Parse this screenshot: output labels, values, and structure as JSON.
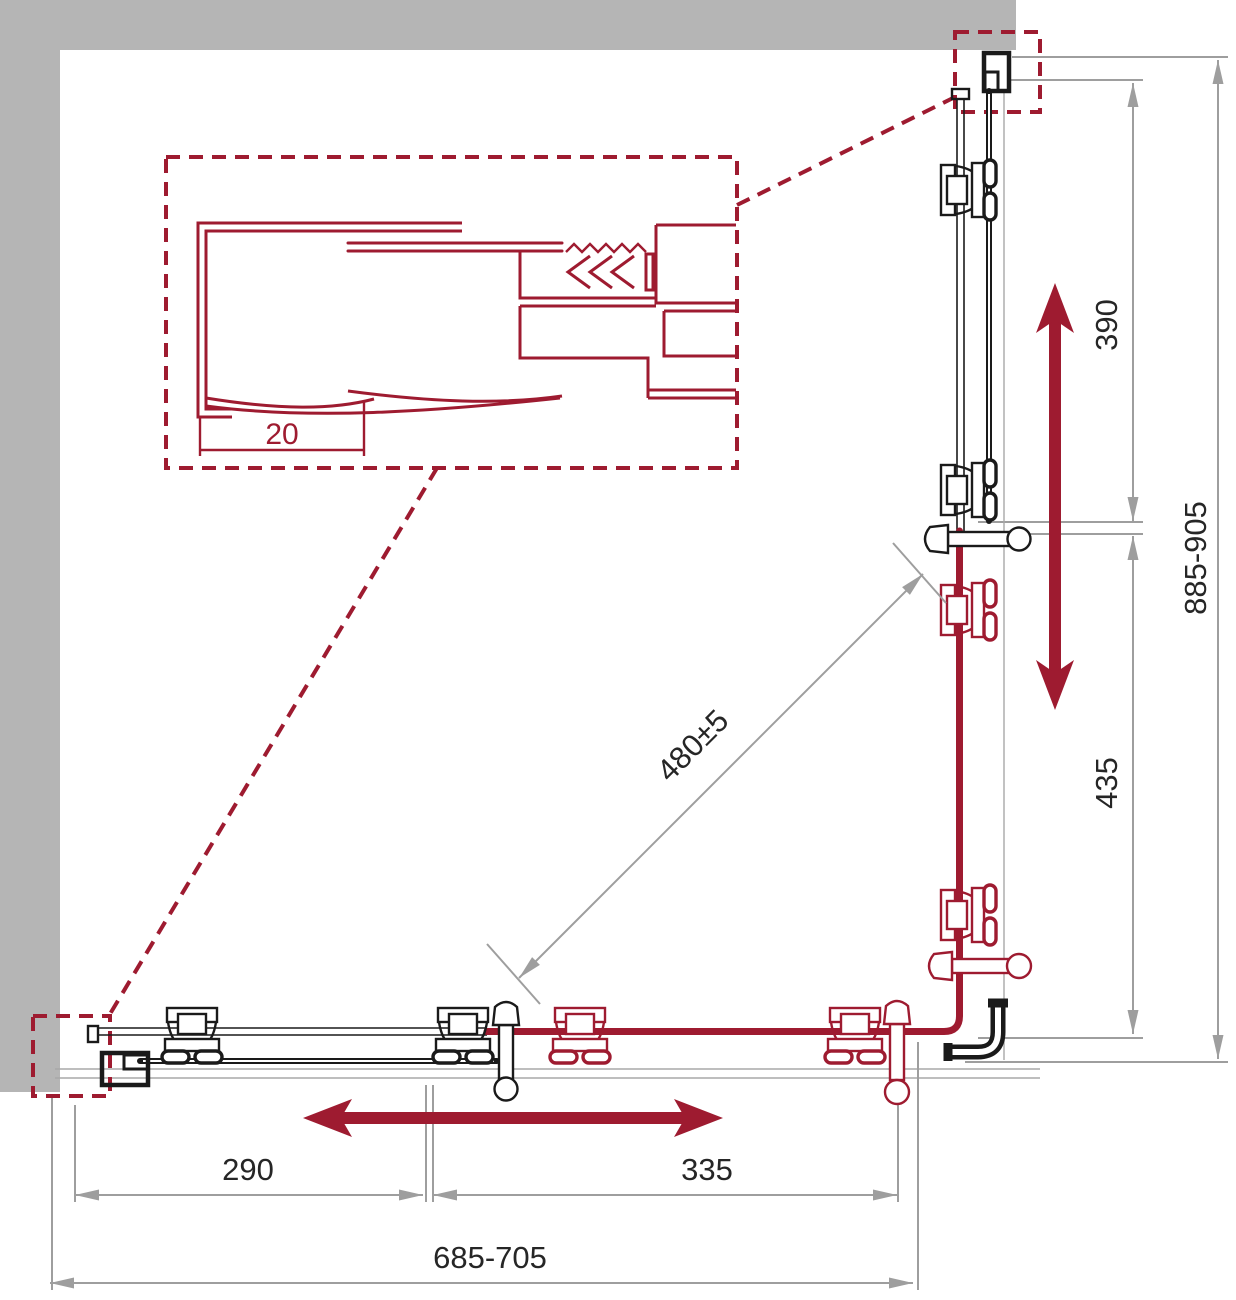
{
  "title": "Corner shower enclosure sliding-door installation diagram (plan view)",
  "colors": {
    "accent_red": "#9e1b30",
    "line_black": "#1a1a1a",
    "dimension_gray": "#9e9e9e",
    "wall_gray": "#b5b5b5"
  },
  "dimensions": {
    "detail_profile_adjust": "20",
    "bottom_inner_left": "290",
    "bottom_inner_right": "335",
    "bottom_overall": "685-705",
    "right_inner_top": "390",
    "right_inner_bottom": "435",
    "right_overall": "885-905",
    "diagonal_opening": "480±5"
  },
  "icons": {
    "slide_direction_vertical": "double-arrow-vertical",
    "slide_direction_horizontal": "double-arrow-horizontal",
    "detail_callout_boxes": "dashed-red-rectangles"
  }
}
